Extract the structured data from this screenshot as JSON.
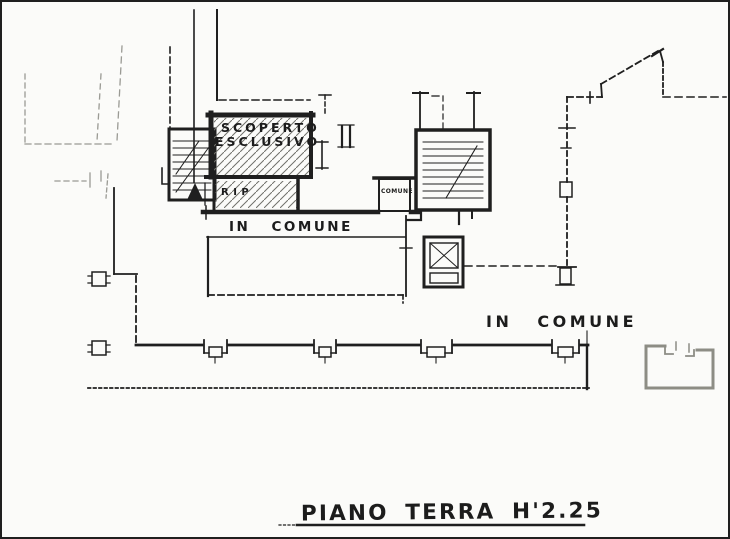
{
  "plan": {
    "title": "PIANO TERRA H'2.25",
    "labels": {
      "scoperto_line1": "SCOPERTO",
      "scoperto_line2": "ESCLUSIVO",
      "rip": "RIP",
      "comune_box": "COMUNE",
      "corridor": "IN COMUNE",
      "common_area": "IN COMUNE"
    },
    "colors": {
      "ink": "#1f1f1f",
      "faint": "#9a9a94",
      "paper": "#fbfbf9",
      "hatch": "#70706a",
      "light_wall": "#8d8d85"
    }
  }
}
